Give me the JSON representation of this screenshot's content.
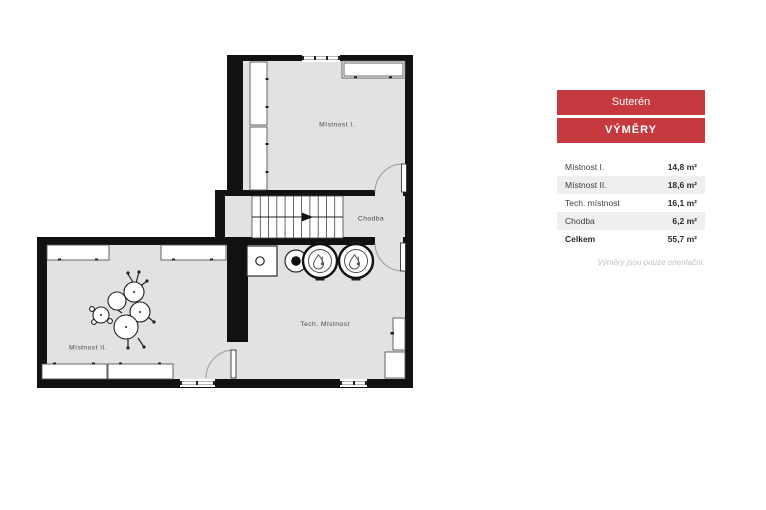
{
  "panel": {
    "floor_button": "Suterén",
    "areas_button": "VÝMĚRY",
    "table": {
      "rows": [
        {
          "label": "Místnost I.",
          "value": "14,8 m²"
        },
        {
          "label": "Místnost II.",
          "value": "18,6 m²"
        },
        {
          "label": "Tech. místnost",
          "value": "16,1 m²"
        },
        {
          "label": "Chodba",
          "value": "6,2 m²"
        },
        {
          "label": "Celkem",
          "value": "55,7 m²"
        }
      ]
    },
    "note": "Výměry jsou pouze orientační."
  },
  "plan": {
    "labels": {
      "room1": "Místnost I.",
      "room2": "Místnost II.",
      "tech": "Tech. Místnost",
      "corridor": "Chodba"
    }
  },
  "colors": {
    "accent_red": "#c5393f",
    "floor_gray": "#e2e2e2",
    "wall_black": "#111111",
    "row_stripe": "#efefef"
  }
}
